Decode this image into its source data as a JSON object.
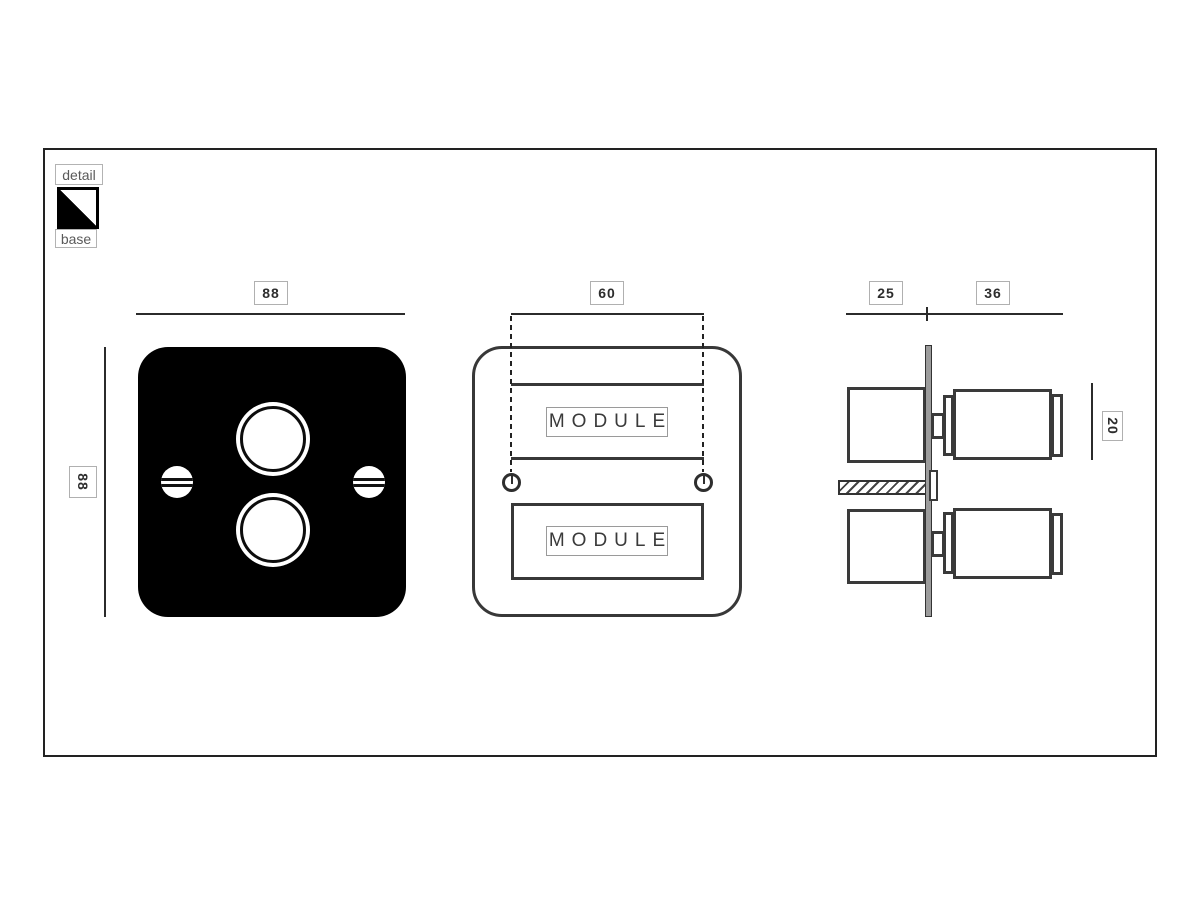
{
  "legend": {
    "detail_label": "detail",
    "base_label": "base",
    "swatch": {
      "detail_color": "#ffffff",
      "base_color": "#000000"
    }
  },
  "views": {
    "front": {
      "title": "base plate front view",
      "width_mm": "88",
      "height_mm": "88",
      "plate_color": "#000000",
      "knob_count": 2,
      "screw_count": 2
    },
    "middle": {
      "title": "base front view",
      "module_width_mm": "60",
      "modules": [
        {
          "label": "MODULE"
        },
        {
          "label": "MODULE"
        }
      ]
    },
    "side": {
      "title": "side section view",
      "box_depth_mm": "25",
      "knob_depth_mm": "36",
      "knob_height_mm": "20"
    }
  },
  "colors": {
    "line": "#2b2b2b",
    "outline": "#3a3a3a",
    "plate_fill": "#000000",
    "bar_fill": "#9c9c9c",
    "dim_box_border": "#b0b0b0"
  }
}
